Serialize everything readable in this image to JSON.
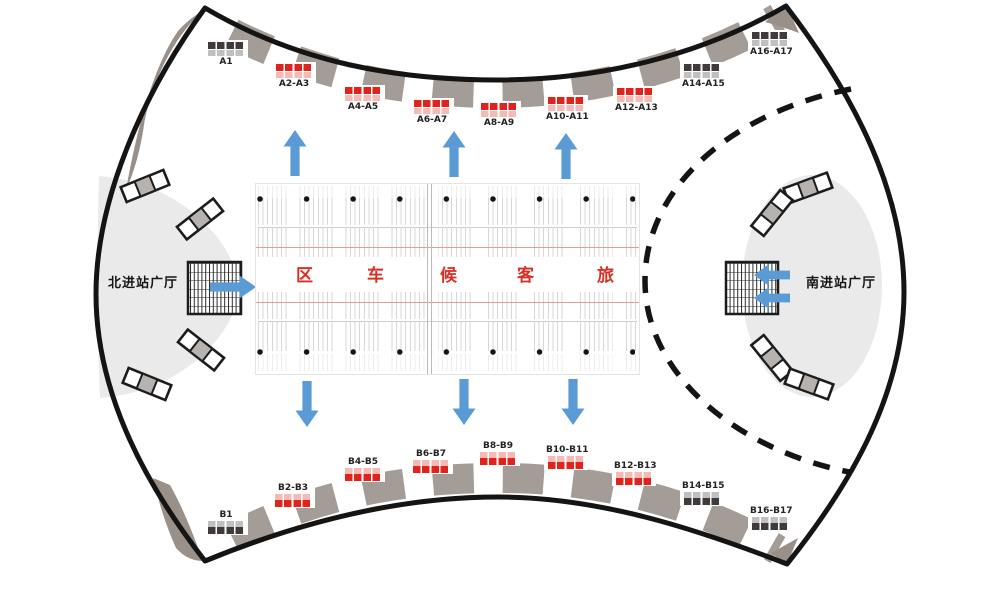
{
  "halls": {
    "north": {
      "label": "北进站广厅"
    },
    "south": {
      "label": "南进站广厅"
    }
  },
  "waiting_area": {
    "chars": [
      "区",
      "车",
      "候",
      "客",
      "旅"
    ]
  },
  "gates": {
    "top": [
      {
        "label": "A1",
        "variant": "dark"
      },
      {
        "label": "A2-A3",
        "variant": "red"
      },
      {
        "label": "A4-A5",
        "variant": "red"
      },
      {
        "label": "A6-A7",
        "variant": "red"
      },
      {
        "label": "A8-A9",
        "variant": "red"
      },
      {
        "label": "A10-A11",
        "variant": "red"
      },
      {
        "label": "A12-A13",
        "variant": "red"
      },
      {
        "label": "A14-A15",
        "variant": "dark"
      },
      {
        "label": "A16-A17",
        "variant": "dark"
      }
    ],
    "bottom": [
      {
        "label": "B1",
        "variant": "dark"
      },
      {
        "label": "B2-B3",
        "variant": "red"
      },
      {
        "label": "B4-B5",
        "variant": "red"
      },
      {
        "label": "B6-B7",
        "variant": "red"
      },
      {
        "label": "B8-B9",
        "variant": "red"
      },
      {
        "label": "B10-B11",
        "variant": "red"
      },
      {
        "label": "B12-B13",
        "variant": "red"
      },
      {
        "label": "B14-B15",
        "variant": "dark"
      },
      {
        "label": "B16-B17",
        "variant": "dark"
      }
    ]
  },
  "colors": {
    "red": "#e0241c",
    "dark": "#3e3b3a",
    "roof": "#a49d97",
    "roofdark": "#99908a",
    "blue": "#5b9bd5",
    "hall": "#eaeaea",
    "ink": "#141414",
    "redtext": "#d93025",
    "redline": "#e0a08e",
    "seatline": "#d7d7d7"
  }
}
